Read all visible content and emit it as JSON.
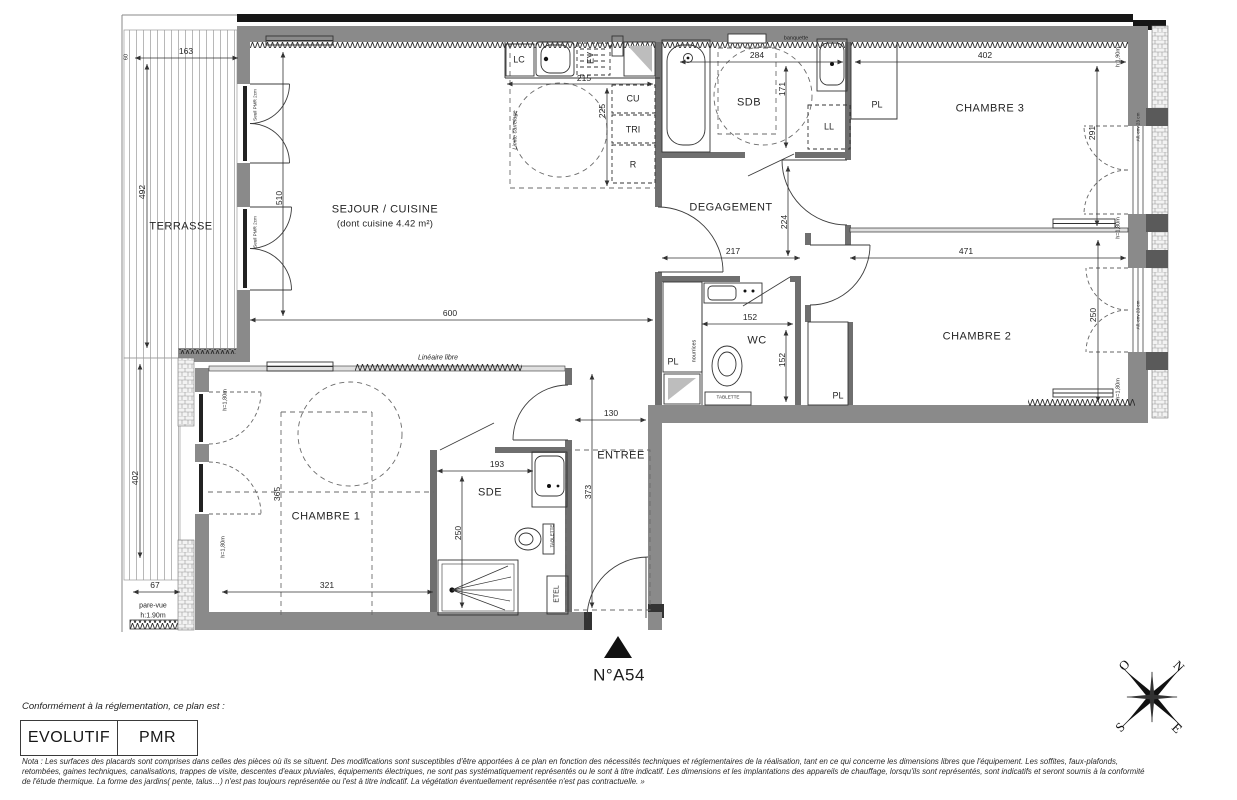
{
  "plan": {
    "unit_number": "N°A54",
    "rooms": {
      "terrasse": "TERRASSE",
      "sejour": "SEJOUR / CUISINE",
      "sejour_sub": "(dont cuisine 4.42 m²)",
      "degagement": "DEGAGEMENT",
      "sdb": "SDB",
      "chambre3": "CHAMBRE 3",
      "chambre2": "CHAMBRE 2",
      "wc": "WC",
      "chambre1": "CHAMBRE 1",
      "sde": "SDE",
      "entree": "ENTREE"
    },
    "fixtures": {
      "lc": "LC",
      "ev": "EV",
      "cu": "CU",
      "tri": "TRI",
      "r": "R",
      "ll": "LL",
      "pl": "PL",
      "etel": "ETEL",
      "tablette": "TABLETTE",
      "nourrices": "nourrices",
      "banquette": "banquette"
    },
    "annotations": {
      "lineaire_libre": "Linéaire libre",
      "limite_carrelage": "Limite carrelage",
      "pare_vue": "pare-vue",
      "pare_vue_h": "h:1.90m",
      "h180": "h=1,80m",
      "h190": "h:1,90m",
      "all_env": "All. env 23 cm",
      "seuil": "Seuil PMR 2cm"
    },
    "dimensions": {
      "d163": "163",
      "d60": "60",
      "d492": "492",
      "d510": "510",
      "d600": "600",
      "d215": "215",
      "d225": "225",
      "d284": "284",
      "d171": "171",
      "d402_top": "402",
      "d291": "291",
      "d217": "217",
      "d224": "224",
      "d471": "471",
      "d250_ch2": "250",
      "d152_h": "152",
      "d152_v": "152",
      "d130": "130",
      "d373": "373",
      "d193": "193",
      "d250_sde": "250",
      "d321": "321",
      "d365": "365",
      "d402_left": "402",
      "d67": "67"
    }
  },
  "compass": {
    "n": "N",
    "s": "S",
    "e": "E",
    "o": "O"
  },
  "footer": {
    "conformity": "Conformément à la réglementation, ce plan est :",
    "evolutif": "EVOLUTIF",
    "pmr": "PMR",
    "nota_line1": "Nota : Les surfaces des placards sont comprises dans celles des pièces où ils se situent. Des modifications sont susceptibles d'être apportées à ce plan en fonction des nécessités techniques et réglementaires de la réalisation, tant en ce qui concerne les dimensions libres que l'équipement.  Les soffites, faux-plafonds,",
    "nota_line2": "retombées, gaines techniques, canalisations, trappes de visite, descentes d'eaux pluviales, équipements électriques, ne sont pas systématiquement représentés ou le sont à titre indicatif. Les dimensions et les implantations des appareils de chauffage, lorsqu'ils sont représentés, sont indicatifs et seront soumis à la conformité",
    "nota_line3": "de l'étude thermique. La forme des jardins( pente, talus…) n'est pas toujours représentée ou l'est à titre indicatif. La végétation éventuellement représentée n'est pas contractuelle. »"
  }
}
